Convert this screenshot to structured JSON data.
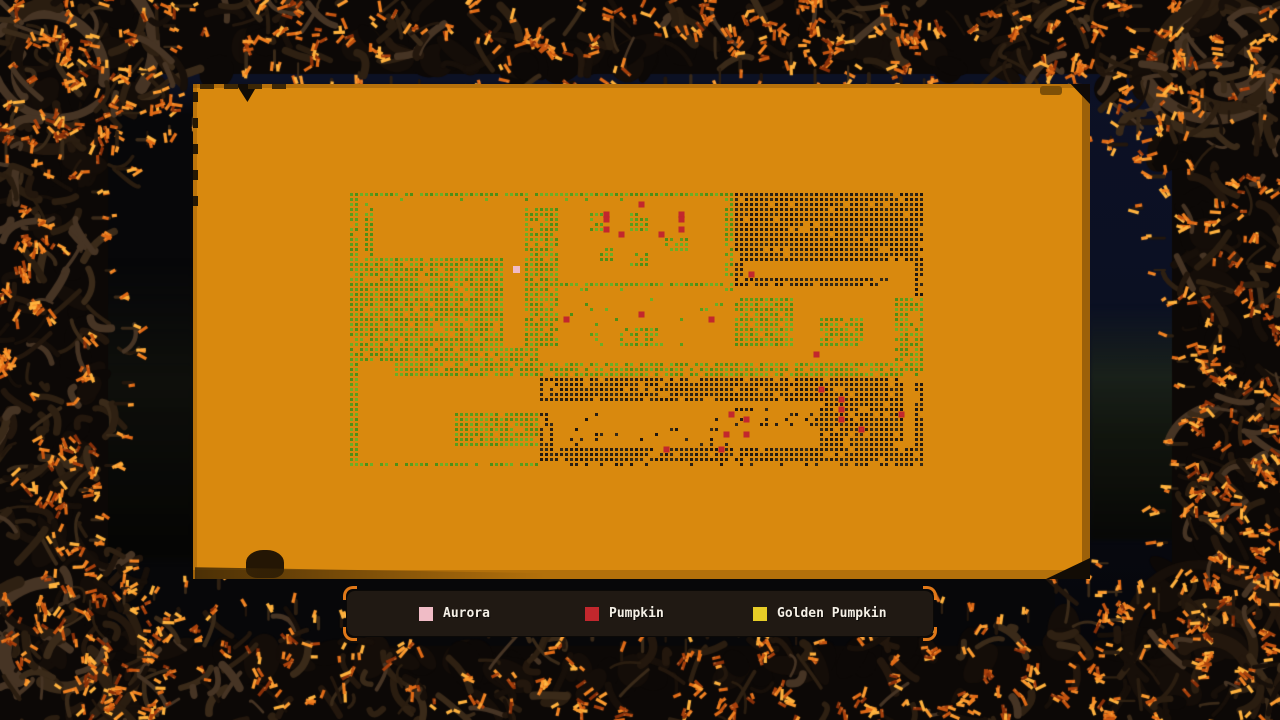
{
  "colors": {
    "background": "#070709",
    "night_sky": "#0c1124",
    "panel": "#d9890e",
    "panel_edge": "#7e5007",
    "legend_bg": "#201913",
    "legend_text": "#f5f0e6",
    "frame_branch": [
      "#170f09",
      "#23170d",
      "#2e2012",
      "#3a2a19",
      "#463424",
      "#2a1d10"
    ],
    "frame_leaf": [
      "#8a3009",
      "#a8400c",
      "#c55410",
      "#e06a16",
      "#f08020",
      "#fb9a2e",
      "#ffb13c",
      "#6e2606"
    ]
  },
  "legend": {
    "items": [
      {
        "id": "aurora",
        "label": "Aurora",
        "color": "#f0bcc6"
      },
      {
        "id": "pumpkin",
        "label": "Pumpkin",
        "color": "#c2272d"
      },
      {
        "id": "golden-pumpkin",
        "label": "Golden Pumpkin",
        "color": "#e7cd27"
      }
    ]
  },
  "map": {
    "origin_x": 350,
    "origin_y": 193,
    "cell": 5,
    "dot": 3,
    "cols": 115,
    "rows": 55,
    "dot_colors": {
      "g": [
        "#5a9c1c",
        "#6cae26",
        "#4f8e16"
      ],
      "k": [
        "#2a2014",
        "#352a18",
        "#201810"
      ],
      "red": "#c2272d",
      "pink": "#f0bcc6",
      "yellow": "#e7cd27"
    },
    "regions": [
      [
        0,
        0,
        74,
        0,
        "g",
        0.95
      ],
      [
        0,
        1,
        60,
        1,
        "g",
        0.16
      ],
      [
        0,
        0,
        1,
        54,
        "g",
        0.95
      ],
      [
        3,
        2,
        4,
        21,
        "g",
        0.85
      ],
      [
        0,
        13,
        30,
        31,
        "g",
        0.93
      ],
      [
        35,
        3,
        41,
        30,
        "g",
        0.93
      ],
      [
        48,
        4,
        50,
        7,
        "g",
        0.8
      ],
      [
        56,
        4,
        59,
        7,
        "g",
        0.8
      ],
      [
        63,
        9,
        67,
        11,
        "g",
        0.8
      ],
      [
        50,
        11,
        52,
        13,
        "g",
        0.7
      ],
      [
        56,
        12,
        59,
        14,
        "g",
        0.7
      ],
      [
        54,
        27,
        61,
        30,
        "g",
        0.75
      ],
      [
        42,
        18,
        74,
        18,
        "g",
        0.9
      ],
      [
        44,
        19,
        58,
        19,
        "g",
        0.35
      ],
      [
        44,
        21,
        74,
        30,
        "g",
        0.05
      ],
      [
        75,
        0,
        76,
        19,
        "g",
        0.85
      ],
      [
        77,
        0,
        114,
        13,
        "k",
        0.94
      ],
      [
        77,
        14,
        78,
        17,
        "k",
        0.8
      ],
      [
        113,
        14,
        114,
        20,
        "k",
        0.8
      ],
      [
        77,
        17,
        107,
        18,
        "k",
        0.8
      ],
      [
        77,
        21,
        88,
        30,
        "g",
        0.92
      ],
      [
        94,
        25,
        102,
        30,
        "g",
        0.92
      ],
      [
        109,
        21,
        114,
        36,
        "g",
        0.85
      ],
      [
        1,
        31,
        37,
        33,
        "g",
        0.9
      ],
      [
        9,
        34,
        108,
        36,
        "g",
        0.88
      ],
      [
        38,
        37,
        107,
        41,
        "k",
        0.9
      ],
      [
        21,
        44,
        37,
        50,
        "g",
        0.92
      ],
      [
        38,
        44,
        40,
        50,
        "k",
        0.7
      ],
      [
        42,
        44,
        75,
        50,
        "k",
        0.1
      ],
      [
        77,
        43,
        93,
        46,
        "k",
        0.3
      ],
      [
        94,
        40,
        108,
        50,
        "k",
        0.9
      ],
      [
        104,
        37,
        108,
        39,
        "k",
        0.7
      ],
      [
        109,
        37,
        110,
        54,
        "k",
        0.85
      ],
      [
        113,
        38,
        114,
        54,
        "k",
        0.85
      ],
      [
        38,
        51,
        112,
        53,
        "k",
        0.9
      ],
      [
        2,
        54,
        38,
        54,
        "g",
        0.8
      ],
      [
        40,
        54,
        112,
        54,
        "k",
        0.4
      ]
    ],
    "markers": {
      "pink": [
        [
          33,
          15
        ]
      ],
      "red": [
        [
          58,
          2
        ],
        [
          51,
          4
        ],
        [
          51,
          5
        ],
        [
          51,
          7
        ],
        [
          66,
          4
        ],
        [
          66,
          5
        ],
        [
          66,
          7
        ],
        [
          54,
          8
        ],
        [
          62,
          8
        ],
        [
          80,
          16
        ],
        [
          43,
          25
        ],
        [
          58,
          24
        ],
        [
          72,
          25
        ],
        [
          93,
          32
        ],
        [
          94,
          39
        ],
        [
          98,
          41
        ],
        [
          98,
          43
        ],
        [
          98,
          45
        ],
        [
          102,
          47
        ],
        [
          63,
          51
        ],
        [
          76,
          44
        ],
        [
          79,
          45
        ],
        [
          75,
          48
        ],
        [
          79,
          48
        ],
        [
          74,
          51
        ],
        [
          110,
          44
        ]
      ],
      "yellow": []
    }
  }
}
